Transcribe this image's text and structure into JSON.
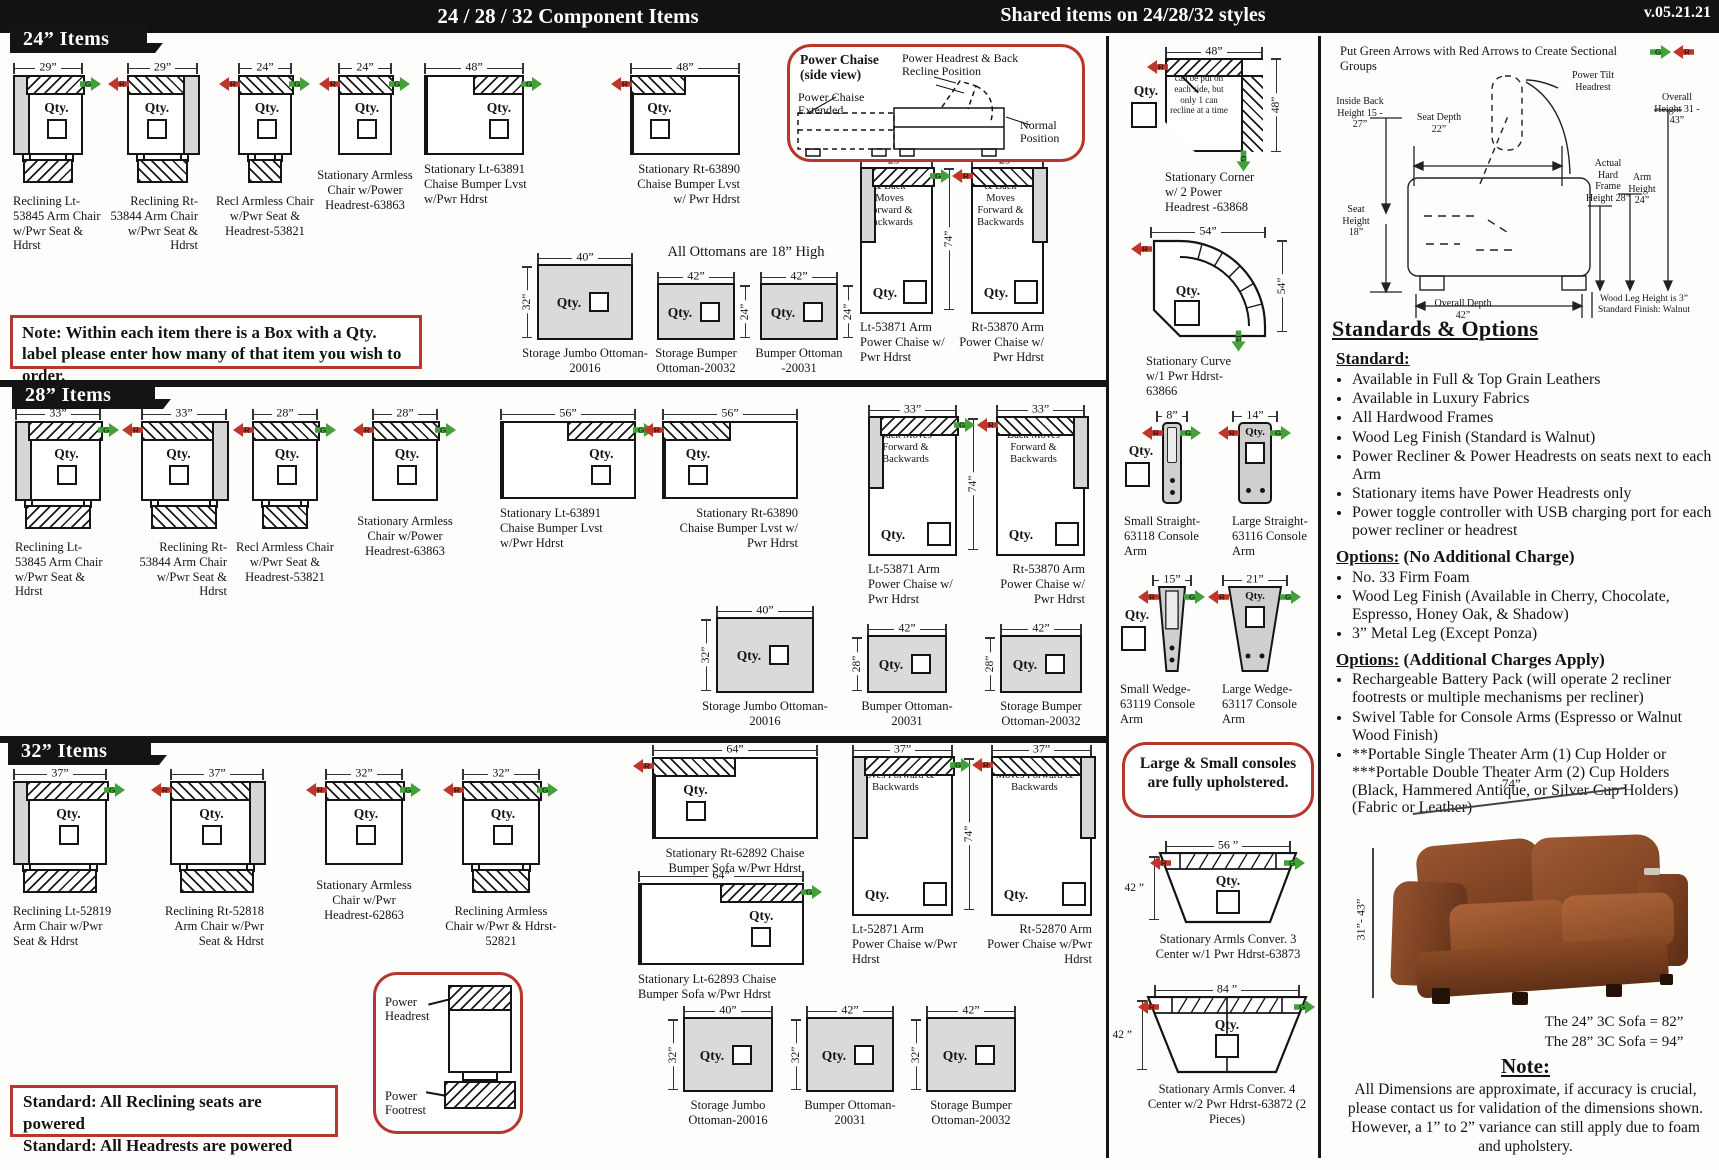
{
  "header": {
    "title": "24 / 28 / 32  Component Items",
    "shared": "Shared items on 24/28/32 styles",
    "version": "v.05.21.21"
  },
  "sections": {
    "s24": "24” Items",
    "s28": "28” Items",
    "s32": "32” Items"
  },
  "qty_label": "Qty.",
  "arrows": {
    "green": "G",
    "red": "R"
  },
  "chaise_text": "Power Seat & Back Moves Forward & Backwards",
  "corner_note": "Reclining items can be put on each side, but only 1 can recline at a time",
  "notes": {
    "qty_note": "Note: Within each item there is a Box with a Qty. label please enter how many of that item you wish to order.",
    "ottoman_height": "All Ottomans are 18” High",
    "standard_powered_1": "Standard: All Reclining seats are powered",
    "standard_powered_2": "Standard: All Headrests are powered",
    "consoles": "Large & Small consoles are fully upholstered.",
    "sectional": "Put Green Arrows with Red Arrows to Create Sectional Groups"
  },
  "power_chaise_box": {
    "title": "Power Chaise",
    "subtitle": "(side view)",
    "label_headrest": "Power Headrest & Back Recline Position",
    "label_extended": "Power Chaise Extended",
    "label_normal": "Normal Position"
  },
  "power_box": {
    "headrest": "Power Headrest",
    "footrest": "Power Footrest"
  },
  "side_diagram": {
    "power_tilt": "Power Tilt Headrest",
    "inside_back": "Inside Back Height 15 - 27”",
    "seat_depth": "Seat Depth 22”",
    "overall_height": "Overall Height 31 - 43”",
    "hard_frame": "Actual Hard Frame Height 28”",
    "arm_height": "Arm Height 24”",
    "seat_height": "Seat Height 18”",
    "overall_depth": "Overall Depth 42”",
    "wood_leg": "Wood Leg Height is 3” Standard Finish: Walnut"
  },
  "standards": {
    "title": "Standards & Options",
    "groups": [
      {
        "heading": "Standard:",
        "suffix": "",
        "bullets": [
          "Available in Full & Top Grain Leathers",
          "Available in Luxury Fabrics",
          "All Hardwood Frames",
          "Wood Leg Finish (Standard is Walnut)",
          "Power Recliner & Power Headrests on seats next to each Arm",
          "Stationary items have Power Headrests only",
          "Power toggle controller with USB charging port for each power recliner or headrest"
        ]
      },
      {
        "heading": "Options:",
        "suffix": " (No Additional Charge)",
        "bullets": [
          "No. 33 Firm Foam",
          "Wood Leg Finish (Available in Cherry, Chocolate, Espresso, Honey Oak, & Shadow)",
          "3” Metal Leg (Except Ponza)"
        ]
      },
      {
        "heading": "Options:",
        "suffix": " (Additional Charges Apply)",
        "bullets": [
          "Rechargeable Battery Pack (will operate 2 recliner footrests or multiple mechanisms per recliner)",
          "Swivel Table for Console Arms (Espresso or Walnut Wood Finish)",
          "**Portable Single Theater Arm (1) Cup Holder or ***Portable Double Theater Arm (2) Cup Holders (Black, Hammered Antique, or Silver Cup Holders) (Fabric or Leather)"
        ]
      }
    ]
  },
  "sofa": {
    "dim_width": "74”",
    "dim_height": "31”- 43”",
    "size1": "The 24” 3C Sofa = 82”",
    "size2": "The 28” 3C Sofa = 94”"
  },
  "note_block": {
    "title": "Note:",
    "text": "All Dimensions are approximate, if accuracy is crucial, please contact us for validation of the dimensions shown. However, a 1” to 2” variance can still apply due to foam and upholstery."
  },
  "items": [
    {
      "v": "chair",
      "x": 13,
      "y": 62,
      "w": 70,
      "dim": "29”",
      "arm": "L",
      "foot": 1,
      "aR": 1,
      "la": "left",
      "lw": 96,
      "label": "Reclining Lt-53845 Arm Chair w/Pwr Seat & Hdrst"
    },
    {
      "v": "chair",
      "x": 127,
      "y": 62,
      "w": 71,
      "dim": "29”",
      "arm": "R",
      "foot": 1,
      "aL": 1,
      "la": "right",
      "lw": 96,
      "label": "Reclining Rt-53844 Arm Chair w/Pwr Seat & Hdrst"
    },
    {
      "v": "chair",
      "x": 238,
      "y": 62,
      "w": 54,
      "dim": "24”",
      "foot": 1,
      "aL": 1,
      "aR": 1,
      "la": "center",
      "lw": 112,
      "label": "Recl Armless Chair w/Pwr Seat & Headrest-53821"
    },
    {
      "v": "chair",
      "x": 338,
      "y": 62,
      "w": 54,
      "dim": "24”",
      "aL": 1,
      "aR": 1,
      "la": "center",
      "lw": 112,
      "label": "Stationary Armless Chair w/Power Headrest-63863"
    },
    {
      "v": "lvst",
      "x": 424,
      "y": 62,
      "w": 100,
      "h": 80,
      "dim": "48”",
      "hatch": "R",
      "aR": 1,
      "la": "left",
      "lw": 112,
      "label": "Stationary Lt-63891 Chaise Bumper Lvst w/Pwr Hdrst"
    },
    {
      "v": "lvst",
      "x": 630,
      "y": 62,
      "w": 110,
      "h": 80,
      "dim": "48”",
      "hatch": "L",
      "aL": 1,
      "la": "right",
      "lw": 112,
      "label": "Stationary Rt-63890 Chaise Bumper Lvst w/ Pwr Hdrst"
    },
    {
      "v": "ottoman",
      "x": 537,
      "y": 252,
      "w": 96,
      "h": 76,
      "dim": "40”",
      "sdim": "32”",
      "ss": "L",
      "label": "Storage Jumbo Ottoman-20016"
    },
    {
      "v": "ottoman",
      "x": 657,
      "y": 271,
      "w": 78,
      "h": 57,
      "dim": "42”",
      "sdim": "24”",
      "ss": "R",
      "label": "Storage Bumper Ottoman-20032"
    },
    {
      "v": "ottoman",
      "x": 760,
      "y": 271,
      "w": 78,
      "h": 57,
      "dim": "42”",
      "sdim": "24”",
      "ss": "R",
      "label": "Bumper Ottoman -20031"
    },
    {
      "v": "pchaise",
      "x": 860,
      "y": 155,
      "w": 73,
      "bh": 147,
      "dim": "29”",
      "arm": "L",
      "aR": 1,
      "la": "left",
      "lw": 88,
      "label": "Lt-53871 Arm Power Chaise w/ Pwr Hdrst"
    },
    {
      "v": "vdim",
      "x": 943,
      "y": 168,
      "h": 142,
      "label": "74”"
    },
    {
      "v": "pchaise",
      "x": 971,
      "y": 155,
      "w": 73,
      "bh": 147,
      "dim": "29”",
      "arm": "R",
      "aL": 1,
      "la": "right",
      "lw": 88,
      "label": "Rt-53870 Arm Power Chaise w/ Pwr Hdrst"
    },
    {
      "v": "chair",
      "x": 15,
      "y": 408,
      "w": 86,
      "dim": "33”",
      "arm": "L",
      "foot": 1,
      "aR": 1,
      "la": "left",
      "lw": 98,
      "label": "Reclining Lt-53845 Arm Chair w/Pwr Seat & Hdrst"
    },
    {
      "v": "chair",
      "x": 141,
      "y": 408,
      "w": 86,
      "dim": "33”",
      "arm": "R",
      "foot": 1,
      "aL": 1,
      "la": "right",
      "lw": 98,
      "label": "Reclining Rt-53844 Arm Chair w/Pwr Seat & Hdrst"
    },
    {
      "v": "chair",
      "x": 252,
      "y": 408,
      "w": 66,
      "dim": "28”",
      "foot": 1,
      "aL": 1,
      "aR": 1,
      "la": "center",
      "lw": 118,
      "label": "Recl Armless Chair w/Pwr Seat & Headrest-53821"
    },
    {
      "v": "chair",
      "x": 372,
      "y": 408,
      "w": 66,
      "dim": "28”",
      "aL": 1,
      "aR": 1,
      "la": "center",
      "lw": 118,
      "label": "Stationary Armless Chair w/Power Headrest-63863"
    },
    {
      "v": "lvst",
      "x": 500,
      "y": 408,
      "w": 136,
      "h": 78,
      "dim": "56”",
      "hatch": "R",
      "aR": 1,
      "la": "left",
      "lw": 128,
      "label": "Stationary Lt-63891 Chaise Bumper Lvst w/Pwr Hdrst"
    },
    {
      "v": "lvst",
      "x": 662,
      "y": 408,
      "w": 136,
      "h": 78,
      "dim": "56”",
      "hatch": "L",
      "aL": 1,
      "la": "right",
      "lw": 128,
      "label": "Stationary Rt-63890 Chaise Bumper Lvst w/ Pwr Hdrst"
    },
    {
      "v": "pchaise",
      "x": 868,
      "y": 404,
      "w": 89,
      "bh": 140,
      "dim": "33”",
      "arm": "L",
      "aR": 1,
      "la": "left",
      "lw": 100,
      "label": "Lt-53871 Arm Power Chaise w/ Pwr Hdrst"
    },
    {
      "v": "vdim",
      "x": 967,
      "y": 418,
      "h": 132,
      "label": "74”"
    },
    {
      "v": "pchaise",
      "x": 996,
      "y": 404,
      "w": 89,
      "bh": 140,
      "dim": "33”",
      "arm": "R",
      "aL": 1,
      "la": "right",
      "lw": 100,
      "label": "Rt-53870 Arm Power Chaise w/ Pwr Hdrst"
    },
    {
      "v": "ottoman",
      "x": 716,
      "y": 605,
      "w": 98,
      "h": 76,
      "dim": "40”",
      "sdim": "32”",
      "ss": "L",
      "label": "Storage Jumbo Ottoman-20016"
    },
    {
      "v": "ottoman",
      "x": 867,
      "y": 623,
      "w": 80,
      "h": 58,
      "dim": "42”",
      "sdim": "28”",
      "ss": "L",
      "label": "Bumper Ottoman-20031"
    },
    {
      "v": "ottoman",
      "x": 1000,
      "y": 623,
      "w": 82,
      "h": 58,
      "dim": "42”",
      "sdim": "28”",
      "ss": "L",
      "label": "Storage Bumper Ottoman-20032"
    },
    {
      "v": "chair",
      "x": 13,
      "y": 768,
      "w": 94,
      "bh": 84,
      "dim": "37”",
      "arm": "L",
      "foot": 1,
      "aR": 1,
      "la": "left",
      "lw": 100,
      "label": "Reclining Lt-52819 Arm Chair w/Pwr Seat & Hdrst"
    },
    {
      "v": "chair",
      "x": 170,
      "y": 768,
      "w": 94,
      "bh": 84,
      "dim": "37”",
      "arm": "R",
      "foot": 1,
      "aL": 1,
      "la": "right",
      "lw": 100,
      "label": "Reclining Rt-52818 Arm Chair w/Pwr Seat & Hdrst"
    },
    {
      "v": "chair",
      "x": 325,
      "y": 768,
      "w": 78,
      "bh": 84,
      "dim": "32”",
      "aL": 1,
      "aR": 1,
      "la": "center",
      "lw": 112,
      "label": "Stationary Armless Chair w/Pwr Headrest-62863"
    },
    {
      "v": "chair",
      "x": 462,
      "y": 768,
      "w": 78,
      "bh": 84,
      "dim": "32”",
      "foot": 1,
      "aL": 1,
      "aR": 1,
      "la": "center",
      "lw": 112,
      "label": "Reclining Armless Chair w/Pwr & Hdrst-52821"
    },
    {
      "v": "lvst",
      "x": 652,
      "y": 744,
      "w": 166,
      "h": 82,
      "dim": "64”",
      "hatch": "L",
      "aL": 1,
      "la": "center",
      "lw": 172,
      "label": "Stationary Rt-62892 Chaise Bumper Sofa w/Pwr Hdrst"
    },
    {
      "v": "lvst",
      "x": 638,
      "y": 870,
      "w": 166,
      "h": 82,
      "dim": "64”",
      "hatch": "R",
      "aR": 1,
      "la": "left",
      "lw": 150,
      "label": "Stationary Lt-62893 Chaise Bumper Sofa w/Pwr Hdrst"
    },
    {
      "v": "pchaise",
      "x": 852,
      "y": 744,
      "w": 101,
      "bh": 160,
      "dim": "37”",
      "arm": "L",
      "aR": 1,
      "la": "left",
      "lw": 106,
      "label": "Lt-52871 Arm Power Chaise w/Pwr Hdrst"
    },
    {
      "v": "vdim",
      "x": 963,
      "y": 758,
      "h": 152,
      "label": "74”"
    },
    {
      "v": "pchaise",
      "x": 991,
      "y": 744,
      "w": 101,
      "bh": 160,
      "dim": "37”",
      "arm": "R",
      "aL": 1,
      "la": "right",
      "lw": 106,
      "label": "Rt-52870 Arm Power Chaise w/Pwr Hdrst"
    },
    {
      "v": "ottoman",
      "x": 683,
      "y": 1005,
      "w": 90,
      "h": 75,
      "dim": "40”",
      "sdim": "32”",
      "ss": "L",
      "label": "Storage Jumbo Ottoman-20016"
    },
    {
      "v": "ottoman",
      "x": 806,
      "y": 1005,
      "w": 88,
      "h": 75,
      "dim": "42”",
      "sdim": "32”",
      "ss": "L",
      "label": "Bumper Ottoman-20031"
    },
    {
      "v": "ottoman",
      "x": 926,
      "y": 1005,
      "w": 90,
      "h": 75,
      "dim": "42”",
      "sdim": "32”",
      "ss": "L",
      "label": "Storage Bumper Ottoman-20032"
    },
    {
      "v": "corner",
      "x": 1165,
      "y": 46,
      "w": 98,
      "h": 94,
      "dim": "48”",
      "sdim": "48”",
      "la": "left",
      "lw": 100,
      "label": "Stationary Corner w/ 2 Power Headrest -63868"
    },
    {
      "v": "curve",
      "x": 1146,
      "y": 226,
      "w": 127,
      "h": 105,
      "dim": "54”",
      "sdim": "54”",
      "la": "left",
      "lw": 96,
      "label": "Stationary Curve w/1 Pwr Hdrst-63866"
    },
    {
      "v": "conS",
      "x": 1162,
      "y": 410,
      "w": 20,
      "h": 82,
      "dim": "8”",
      "la": "left",
      "lw": 88,
      "label": "Small Straight-63118 Console Arm"
    },
    {
      "v": "conL",
      "x": 1238,
      "y": 410,
      "w": 34,
      "h": 82,
      "dim": "14”",
      "la": "left",
      "lw": 88,
      "label": "Large Straight-63116 Console Arm"
    },
    {
      "v": "conS",
      "x": 1158,
      "y": 574,
      "w": 28,
      "h": 86,
      "dim": "15”",
      "wedge": 1,
      "la": "left",
      "lw": 88,
      "label": "Small Wedge-63119 Console Arm"
    },
    {
      "v": "conL",
      "x": 1228,
      "y": 574,
      "w": 54,
      "h": 86,
      "dim": "21”",
      "wedge": 1,
      "la": "left",
      "lw": 88,
      "label": "Large Wedge-63117 Console Arm"
    },
    {
      "v": "conver",
      "x": 1158,
      "y": 840,
      "w": 140,
      "h": 72,
      "dim": "56 ”",
      "sdim": "42 ”",
      "la": "center",
      "lw": 164,
      "label": "Stationary Armls Conver. 3 Center w/1 Pwr Hdrst-63873"
    },
    {
      "v": "conver",
      "x": 1146,
      "y": 984,
      "w": 162,
      "h": 78,
      "dim": "84 ”",
      "sdim": "42 ”",
      "seam": 1,
      "la": "center",
      "lw": 170,
      "label": "Stationary Armls Conver. 4 Center w/2 Pwr Hdrst-63872 (2 Pieces)"
    }
  ]
}
